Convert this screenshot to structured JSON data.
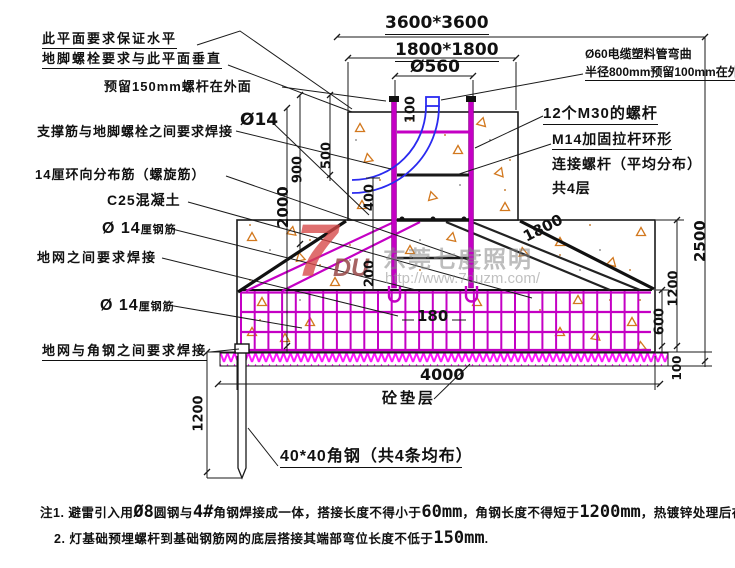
{
  "labels": {
    "plane_level": "此平面要求保证水平",
    "anchor_perpendicular": "地脚螺栓要求与此平面垂直",
    "reserve_150": "预留150mm螺杆在外面",
    "support_weld": "支撑筋与地脚螺栓之间要求焊接",
    "dia14": "Ø14",
    "spiral": "14厘环向分布筋（螺旋筋）",
    "concrete": "C25混凝土",
    "rebar14_prefix": "Ø 14",
    "rebar14_suffix": "厘钢筋",
    "ground_net_weld": "地网之间要求焊接",
    "net_angle_weld": "地网与角钢之间要求焊接",
    "cable_pipe_1": "Ø60电缆塑料管弯曲",
    "cable_pipe_2": "半径800mm预留100mm在外面",
    "bolts_m30": "12个M30的螺杆",
    "tie_m14_1": "M14加固拉杆环形",
    "tie_m14_2": "连接螺杆（平均分布）",
    "tie_m14_3": "共4层",
    "cushion": "砼垫层",
    "angle_steel": "40*40角钢（共4条均布）"
  },
  "dimensions": {
    "plan_outer": "3600*3600",
    "plan_pedestal": "1800*1800",
    "bolt_circle": "Ø560",
    "d100_top": "100",
    "d500": "500",
    "d900": "900",
    "d2000": "2000",
    "d400": "400",
    "d200": "200",
    "d1800_slope": "1800",
    "d2500": "2500",
    "d1200_right": "1200",
    "d600": "600",
    "d100_right": "100",
    "d180": "180",
    "d4000": "4000",
    "d1200_left": "1200"
  },
  "notes": {
    "n1_a": "注1. 避雷引入用",
    "n1_b": "Ø8",
    "n1_c": "圆钢与",
    "n1_d": "4#",
    "n1_e": "角钢焊接成一体，搭接长度不得小于",
    "n1_f": "60mm",
    "n1_g": "，角钢长度不得短于",
    "n1_h": "1200mm",
    "n1_i": "，热镀锌处理后在浇入素砼前打入基础坑底",
    "n2_a": "2. 灯基础预埋螺杆到基础钢筋网的底层搭接其端部弯位长度不低于",
    "n2_b": "150mm",
    "n2_c": "."
  },
  "watermark": {
    "logo_7": "7",
    "logo_du": "DU",
    "company": "东莞七度照明",
    "url": "http://www.7duzm.com/"
  },
  "colors": {
    "line": "#1a1a1a",
    "rebar_magenta": "#c400c4",
    "conduit_blue": "#2a2af0",
    "aggregate_orange": "#d2781e",
    "hatch_magenta": "#ff17ff"
  }
}
